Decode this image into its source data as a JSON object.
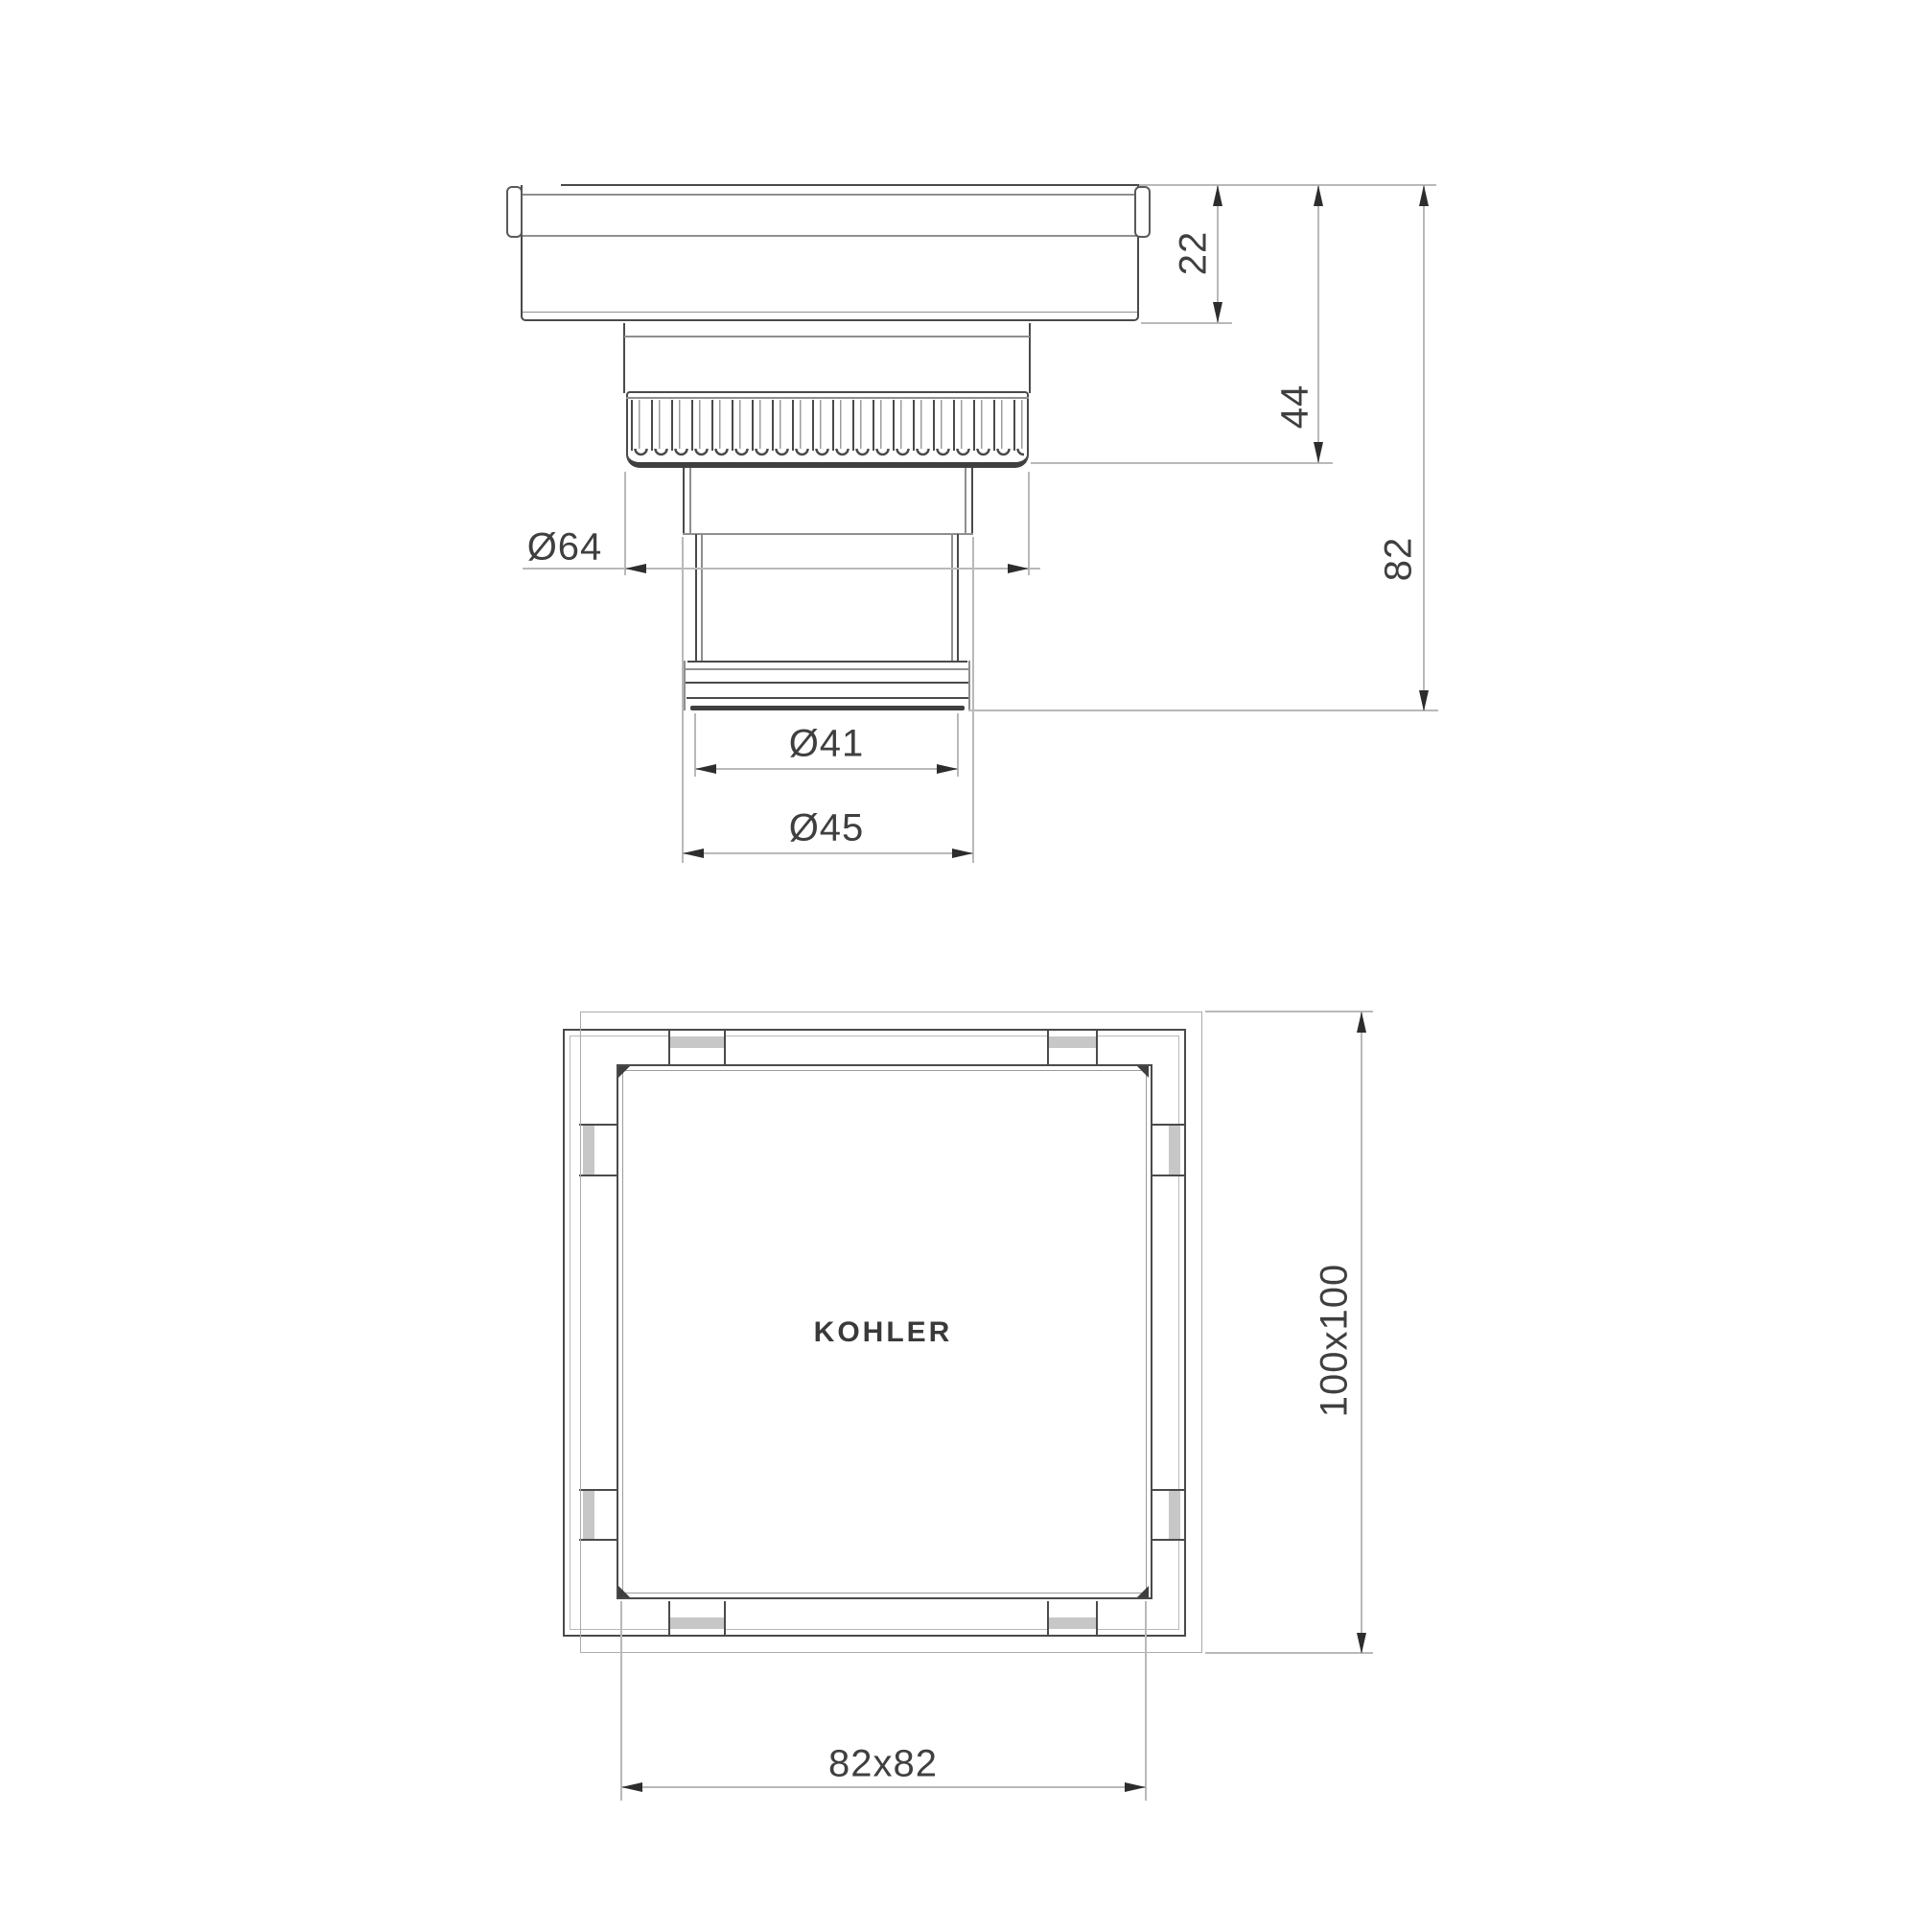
{
  "colors": {
    "outline": "#4a4a4a",
    "dimension_line": "#b9b9b9",
    "text": "#3f3f3f"
  },
  "side_view": {
    "flange_height_mm": "22",
    "nut_depth_mm": "44",
    "total_height_mm": "82",
    "nut_diameter": "Ø64",
    "outlet_tip_diameter": "Ø41",
    "outlet_diameter": "Ø45"
  },
  "top_view": {
    "overall_size_mm": "100x100",
    "grate_size_mm": "82x82",
    "brand": "KOHLER"
  }
}
